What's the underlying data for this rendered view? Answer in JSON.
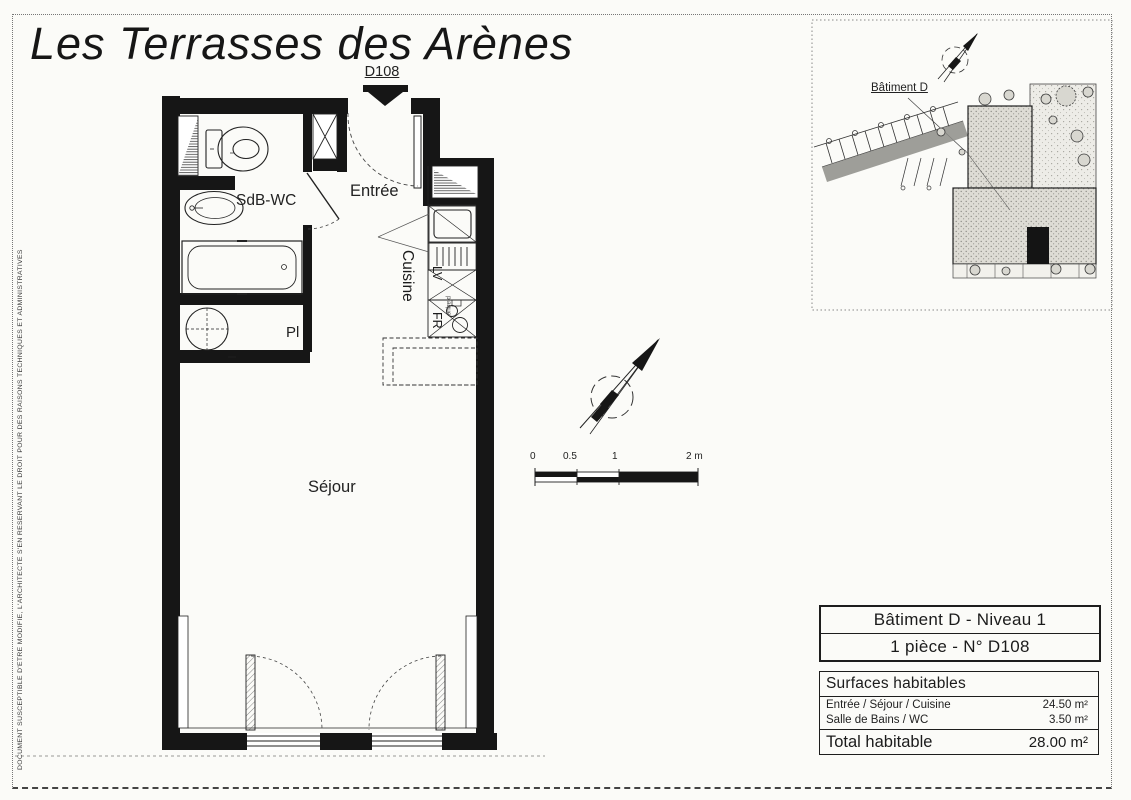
{
  "page": {
    "title": "Les Terrasses des Arènes",
    "disclaimer": "DOCUMENT SUSCEPTIBLE D'ETRE MODIFIE, L'ARCHITECTE S'EN RESERVANT LE DROIT POUR DES RAISONS TECHNIQUES ET ADMINISTRATIVES"
  },
  "plan": {
    "unit_label": "D108",
    "rooms": {
      "bathroom": "SdB-WC",
      "entrance": "Entrée",
      "kitchen": "Cuisine",
      "living": "Séjour",
      "closet": "Pl"
    },
    "appliances": {
      "dishwasher": "LV",
      "fridge": "FR",
      "hob": "plaque"
    }
  },
  "scale_bar": {
    "t0": "0",
    "t05": "0.5",
    "t1": "1",
    "t2": "2 m"
  },
  "site_plan": {
    "building_label": "Bâtiment D"
  },
  "info": {
    "building_line": "Bâtiment D - Niveau 1",
    "unit_line": "1 pièce - N° D108",
    "surfaces": {
      "title": "Surfaces habitables",
      "rows": [
        {
          "label": "Entrée / Séjour / Cuisine",
          "value": "24.50 m²"
        },
        {
          "label": "Salle de Bains / WC",
          "value": "3.50 m²"
        }
      ],
      "total_label": "Total habitable",
      "total_value": "28.00 m²"
    }
  },
  "colors": {
    "wall": "#161616",
    "paper": "#fbfbf8",
    "ink": "#1b1b1b"
  }
}
